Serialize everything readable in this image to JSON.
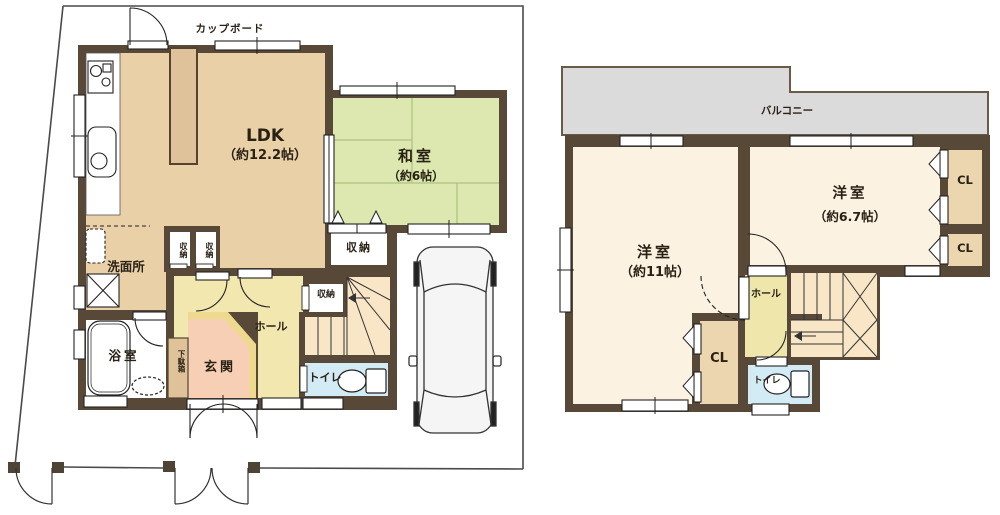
{
  "title": "2-story house floor plan",
  "colors": {
    "wall": "#584838",
    "flooring_tan": "#e9d0a7",
    "tatami_green": "#dce8af",
    "hall_yellow": "#f2e7ae",
    "genkan_peach": "#f6cfb5",
    "genkan_step_yellow": "#eeda8e",
    "cabinet_tan": "#dfc19a",
    "stairs_cream": "#f9e6c6",
    "toilet_blue": "#d3ebf4",
    "bedroom_cream": "#fbf2e1",
    "closet_tan": "#ecd6b0",
    "balcony_gray": "#dbdbdb"
  },
  "floor1": {
    "cupboard_label": "カップボード",
    "ldk_name": "LDK",
    "ldk_area": "（約12.2帖）",
    "washitsu_name": "和室",
    "washitsu_area": "（約6帖）",
    "storage_washitsu": "収納",
    "storage_stairs": "収納",
    "closet_left": "収納",
    "closet_right": "収納",
    "senmenjo": "洗面所",
    "yokushitsu": "浴室",
    "getabako": "下駄箱",
    "genkan": "玄関",
    "hall": "ホール",
    "toilet": "トイレ"
  },
  "floor2": {
    "balcony": "バルコニー",
    "bedroom1_name": "洋室",
    "bedroom1_area": "（約11帖）",
    "bedroom2_name": "洋室",
    "bedroom2_area": "（約6.7帖）",
    "cl_top": "CL",
    "cl_mid": "CL",
    "cl_left": "CL",
    "hall": "ホール",
    "toilet": "トイレ"
  }
}
